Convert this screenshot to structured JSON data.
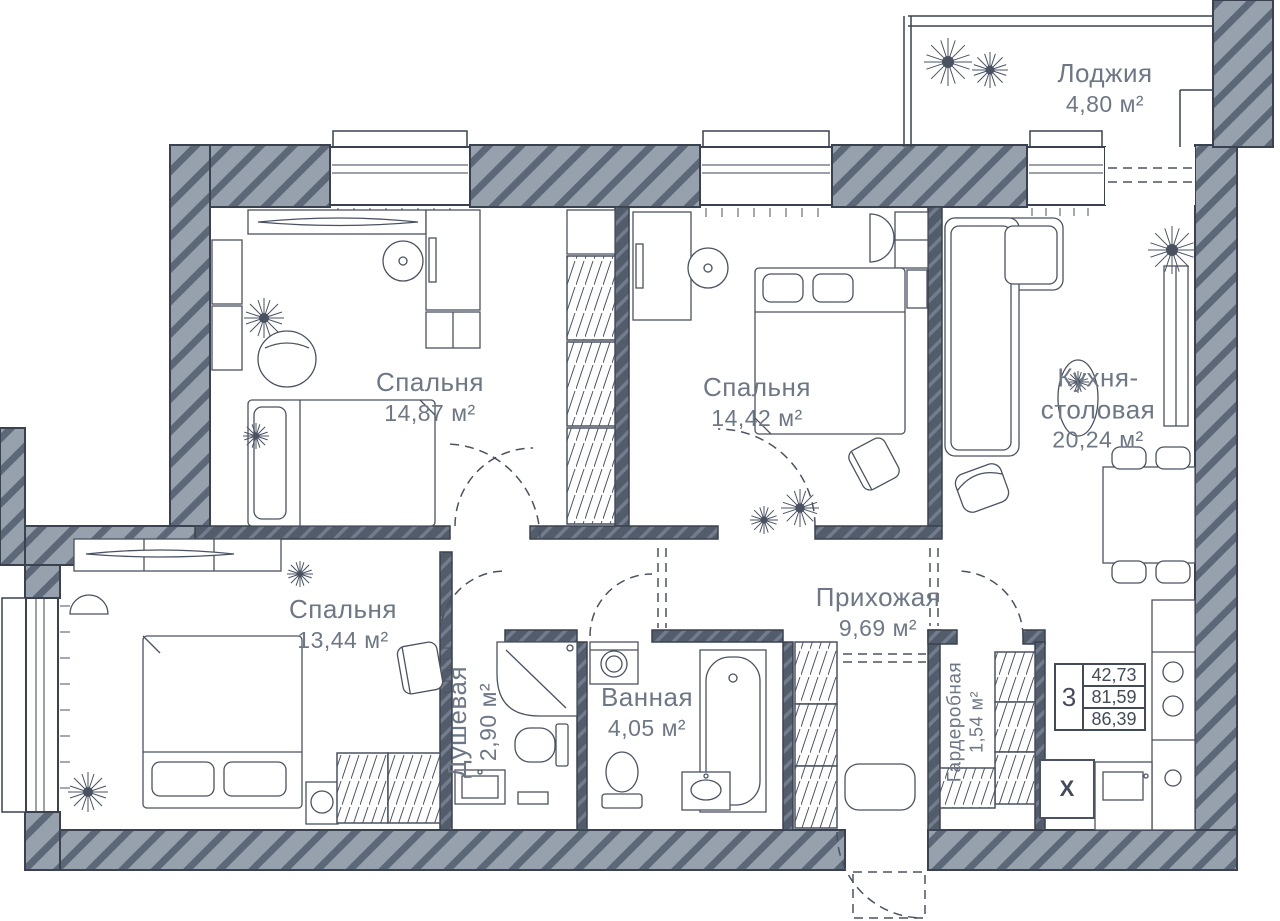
{
  "plan": {
    "rooms": [
      {
        "id": "loggia",
        "name": "Лоджия",
        "area": "4,80 м²"
      },
      {
        "id": "bedroom-1",
        "name": "Спальня",
        "area": "14,87 м²"
      },
      {
        "id": "bedroom-2",
        "name": "Спальня",
        "area": "14,42 м²"
      },
      {
        "id": "kitchen-dining",
        "name": "Кухня-столовая",
        "area": "20,24 м²"
      },
      {
        "id": "bedroom-3",
        "name": "Спальня",
        "area": "13,44 м²"
      },
      {
        "id": "hallway",
        "name": "Прихожая",
        "area": "9,69 м²"
      },
      {
        "id": "shower-room",
        "name": "Душевая",
        "area": "2,90 м²"
      },
      {
        "id": "bathroom",
        "name": "Ванная",
        "area": "4,05 м²"
      },
      {
        "id": "walk-in-closet",
        "name": "Гардеробная",
        "area": "1,54 м²"
      }
    ],
    "summary": {
      "rooms_count": "3",
      "living_area": "42,73",
      "floor_area": "81,59",
      "total_area": "86,39"
    },
    "markers": {
      "washing_machine": "X"
    },
    "colors": {
      "wall_fill": "#97a0ad",
      "wall_stripe": "#5c6777",
      "interior_wall": "#525c6b",
      "outline": "#3a4250",
      "furniture_line": "#4a5262",
      "label_text": "#6e7786",
      "value_text": "#434b59"
    }
  }
}
